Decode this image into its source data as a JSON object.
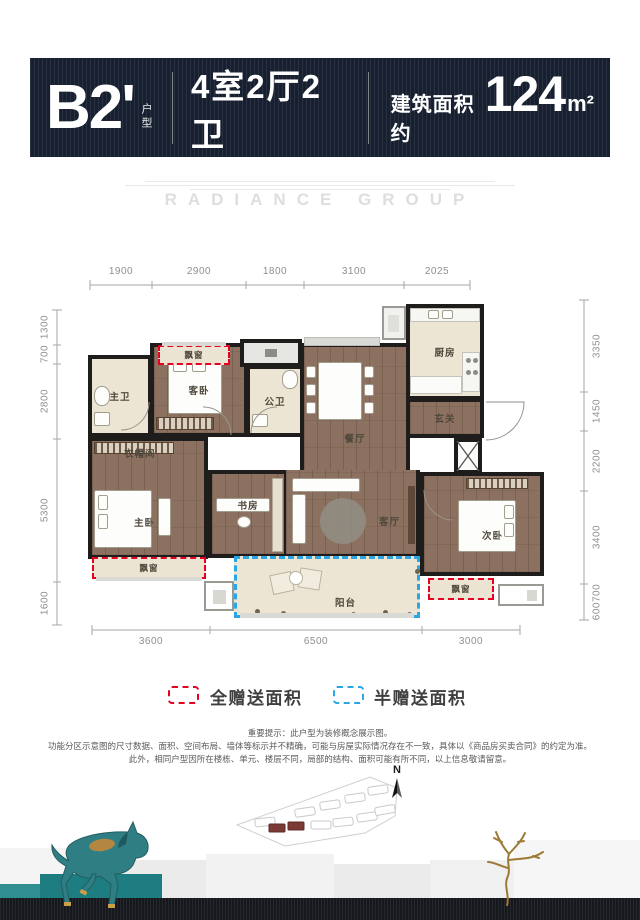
{
  "header": {
    "unit": "B2'",
    "unit_suffix": "户型",
    "layout": "4室2厅2卫",
    "area_prefix": "建筑面积约",
    "area_value": "124",
    "area_unit": "m²"
  },
  "watermark": "RADIANCE GROUP",
  "dimensions": {
    "top": [
      "1900",
      "2900",
      "1800",
      "3100",
      "2025"
    ],
    "bottom": [
      "3600",
      "6500",
      "3000"
    ],
    "left": [
      "1300",
      "700",
      "2800",
      "5300",
      "1600"
    ],
    "right": [
      "3350",
      "1450",
      "2200",
      "3400",
      "600700"
    ]
  },
  "rooms": {
    "master_bath": "主卫",
    "guest_bed": "客卧",
    "bay_top": "飘窗",
    "public_bath": "公卫",
    "kitchen": "厨房",
    "foyer": "玄关",
    "dining": "餐厅",
    "closet": "衣帽间",
    "master_bed": "主卧",
    "bay_left": "飘窗",
    "study": "书房",
    "living": "客厅",
    "second_bed": "次卧",
    "bay_right": "飘窗",
    "balcony": "阳台"
  },
  "legend": {
    "full": "全赠送面积",
    "half": "半赠送面积",
    "full_color": "#e60021",
    "half_color": "#2aa7e2"
  },
  "disclaimer": [
    "重要提示：此户型为装修概念展示图。",
    "功能分区示意图的尺寸数据、面积、空间布局、墙体等标示并不精确，可能与房屋实际情况存在不一致，具体以《商品房买卖合同》的约定为准。",
    "此外，相同户型因所在楼栋、单元、楼层不同，局部的结构、面积可能有所不同，以上信息敬请留意。"
  ],
  "compass": {
    "label": "N"
  }
}
